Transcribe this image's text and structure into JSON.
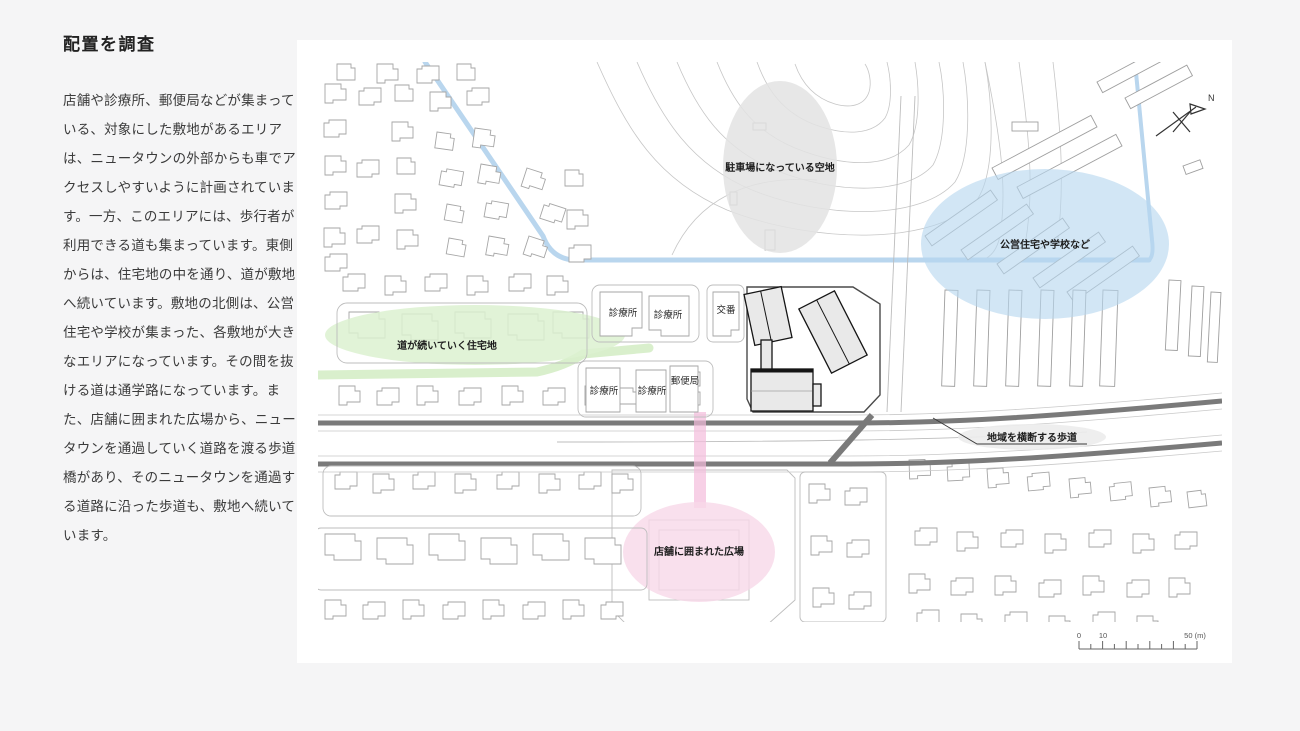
{
  "article": {
    "title": "配置を調査",
    "body": "店舗や診療所、郵便局などが集まっている、対象にした敷地があるエリアは、ニュータウンの外部からも車でアクセスしやすいように計画されています。一方、このエリアには、歩行者が利用できる道も集まっています。東側からは、住宅地の中を通り、道が敷地へ続いています。敷地の北側は、公営住宅や学校が集まった、各敷地が大きなエリアになっています。その間を抜ける道は通学路になっています。また、店舗に囲まれた広場から、ニュータウンを通過していく道路を渡る歩道橋があり、そのニュータウンを通過する道路に沿った歩道も、敷地へ続いています。"
  },
  "map": {
    "annotations": {
      "parking": {
        "label": "駐車場になっている空地",
        "color": "#e3e3e3"
      },
      "public_housing": {
        "label": "公営住宅や学校など",
        "color": "#b7d6ef"
      },
      "residential": {
        "label": "道が続いていく住宅地",
        "color": "#dcf1d0"
      },
      "plaza": {
        "label": "店舗に囲まれた広場",
        "color": "#f8d8e9"
      },
      "crosswalk": {
        "label": "地域を横断する歩道"
      },
      "bridge_color": "#f3bcdb",
      "stream_color": "#b9d6ee"
    },
    "poi": {
      "clinic": "診療所",
      "police": "交番",
      "post_office": "郵便局"
    },
    "compass": {
      "label": "N"
    },
    "scale": {
      "zero": "0",
      "ten": "10",
      "end": "50 (m)"
    }
  }
}
